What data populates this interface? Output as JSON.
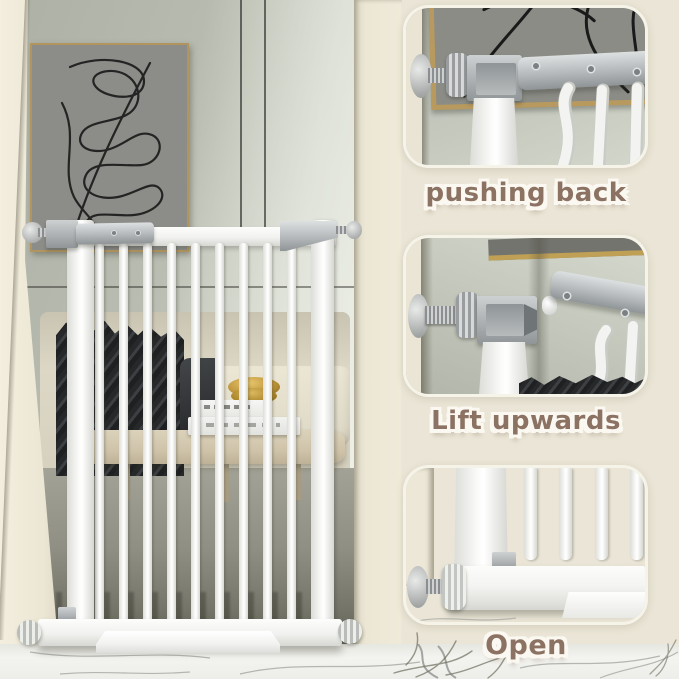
{
  "steps": [
    {
      "label": "pushing back"
    },
    {
      "label": "Lift upwards"
    },
    {
      "label": "Open"
    }
  ],
  "colors": {
    "background_cream": "#eae5d6",
    "label_brown": "#8c7263",
    "wall_gray": "#bcc0b4",
    "gate_white": "#f5f6f3",
    "hardware_silver": "#aeb2b4",
    "picture_frame_gold": "#b79a5d",
    "marble_floor": "#efefeb",
    "blanket_dark": "#2e3032",
    "table_wood": "#d3c8b0",
    "brass_decor": "#c2a04f"
  }
}
